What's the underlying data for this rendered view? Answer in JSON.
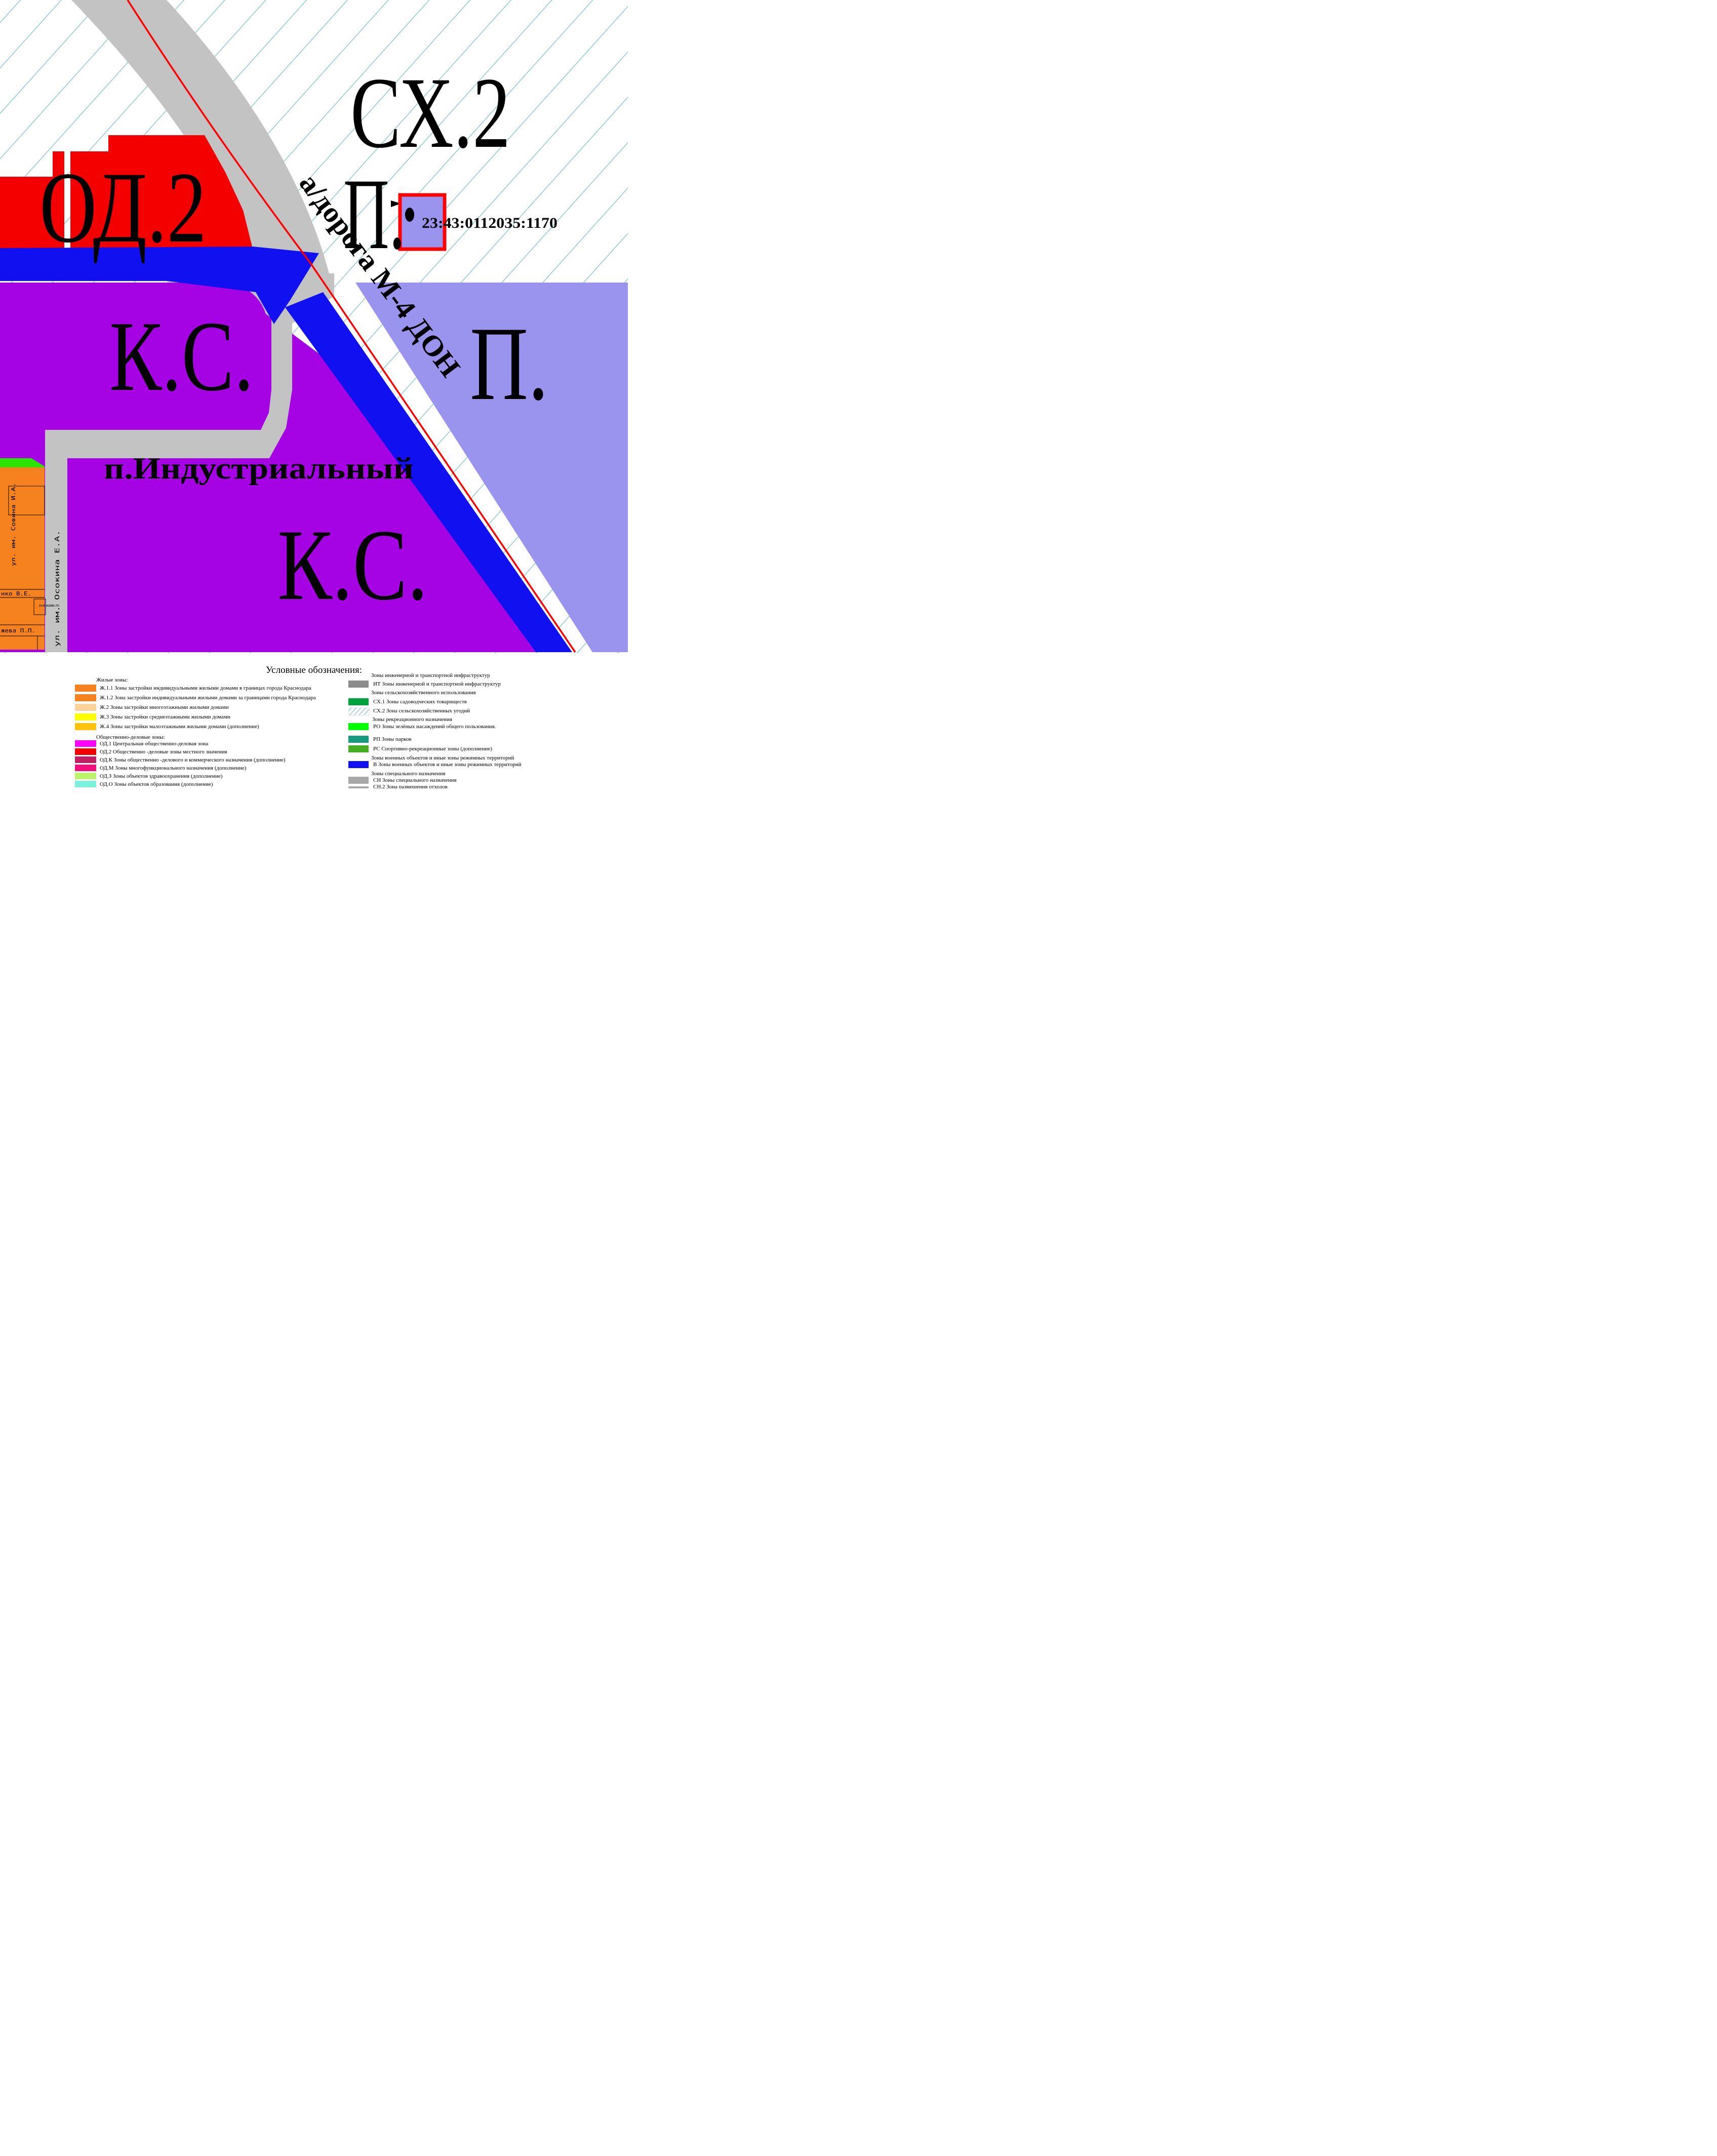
{
  "map": {
    "zone_labels": {
      "sx2": "СХ.2",
      "p_top": "П.",
      "od2": "ОД.2",
      "ks_upper": "К.С.",
      "p_right": "П.",
      "settlement": "п.Индустриальный",
      "ks_lower": "К.С.",
      "road": "а/дорога М-4 ДОН"
    },
    "parcels": {
      "highlight_number": "23:43:0112035:1170",
      "small_number": "23:43:0125001:771"
    },
    "streets": {
      "osokina": "ул. им. Осокина Е.А.",
      "savina": "ул. им. Совина И.А.",
      "ve": "нко  В.Е.",
      "pp": "жева  П.П."
    }
  },
  "colors": {
    "red": "#F40000",
    "blue": "#1010F0",
    "purple": "#A503E3",
    "lavender": "#9B94EE",
    "road_gray": "#C3C3C3",
    "hatch": "#6FBFBF",
    "orange": "#F5821F",
    "green": "#2BE400",
    "red_line": "#FF0000",
    "parcel_outline": "#FF0000",
    "street_teal": "#5FB4CF",
    "cadastral_blue": "#2850C0",
    "black": "#000000"
  },
  "legend": {
    "title": "Условные обозначения:",
    "left": [
      {
        "type": "header",
        "label": "Жилые зоны:"
      },
      {
        "type": "item",
        "color": "#F5821F",
        "label": "Ж.1.1 Зоны застройки индивидуальными жилыми домами в границах города Краснодара"
      },
      {
        "type": "item",
        "color": "#F5821F",
        "label": "Ж.1.2 Зона застройки индивидуальными жилыми домами за границами города Краснодара"
      },
      {
        "type": "item",
        "color": "#FAD49B",
        "label": "Ж.2 Зоны застройки многоэтажными жилыми домами"
      },
      {
        "type": "item",
        "color": "#FFFF00",
        "label": "Ж.3 Зоны застройки  среднеэтажными жилыми домами"
      },
      {
        "type": "item",
        "color": "#FFC20D",
        "label": "Ж.4 Зоны застройки  малоэтажными жилыми домами   (дополнение)"
      },
      {
        "type": "header",
        "label": "Общественно-деловые зоны:"
      },
      {
        "type": "item",
        "color": "#FF00FF",
        "label": "ОД.1 Центральная общественно-деловая зона"
      },
      {
        "type": "item",
        "color": "#F40000",
        "label": "ОД.2 Общественно -деловые зоны местного значения"
      },
      {
        "type": "item",
        "color": "#C41E63",
        "label": "ОД.К Зоны общественно -делового и коммерческого назначения   (дополнение)"
      },
      {
        "type": "item",
        "color": "#F0107C",
        "label": "ОД.М Зоны многофункционального назначения   (дополнение)"
      },
      {
        "type": "item",
        "color": "#BDF26B",
        "label": "ОД.З Зоны объектов здравоохранения  (дополнение)"
      },
      {
        "type": "item",
        "color": "#7CF2DC",
        "label": "ОД.О Зоны объектов образования  (дополнение)"
      }
    ],
    "right": [
      {
        "type": "header",
        "label": "Зоны инженерной и транспортной инфраструктур"
      },
      {
        "type": "item",
        "color": "#8C8C8C",
        "label": "ИТ Зоны инженерной и транспортной инфраструктур"
      },
      {
        "type": "header",
        "label": "Зоны сельскохозяйственного использования"
      },
      {
        "type": "item",
        "color": "#00A23C",
        "label": "СХ.1 Зоны садоводческих товариществ"
      },
      {
        "type": "item",
        "color": "hatched",
        "label": "СХ.2 Зона сельскохозяйственных угодий"
      },
      {
        "type": "header",
        "label": "Зоны рекреационного назначения"
      },
      {
        "type": "item",
        "color": "#00FF00",
        "label": "РО Зоны зелёных насаждений общего пользования."
      },
      {
        "type": "item",
        "color": "#169B7E",
        "label": "РП Зоны парков"
      },
      {
        "type": "item",
        "color": "#47AD23",
        "label": "РС Спортивно-рекреационные зоны (дополнение)"
      },
      {
        "type": "header",
        "label": "Зоны военных объектов и иные зоны режимных территорий"
      },
      {
        "type": "item",
        "color": "#1010F0",
        "label": "В Зоны военных объектов и иные зоны режимных территорий"
      },
      {
        "type": "header",
        "label": "Зоны специального назначения"
      },
      {
        "type": "item",
        "color": "#A8A8A8",
        "label": "СН Зоны специального назначения"
      },
      {
        "type": "item",
        "color": "#A8A8A8",
        "label": "СН.2 Зона размещения отходов"
      }
    ]
  }
}
